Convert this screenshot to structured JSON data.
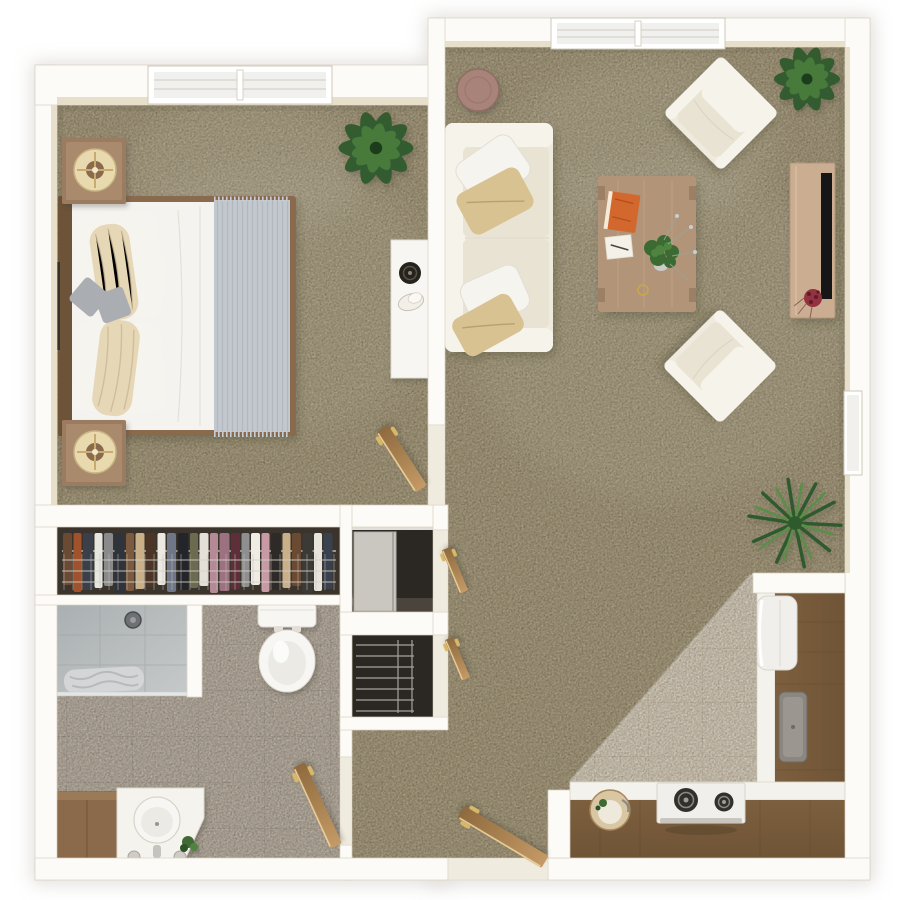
{
  "meta": {
    "title": "Top-down 3D floor plan render of a one-bedroom apartment",
    "style": "photoreal 3D dollhouse floorplan",
    "rooms_count": 6,
    "windows_count": 3,
    "doors_count": 5
  },
  "palette": {
    "page_bg": "#ffffff",
    "wall": "#fcfbf7",
    "wall_stroke": "#d9d2c2",
    "wall_inner": "#e8dfca",
    "threshold": "#f0ebdf",
    "halo": "#c9c5bd",
    "carpet": "#a09271",
    "tile_kitchen": "#d7cbb7",
    "tile_kitchen_line": "#c3b59f",
    "tile_bath": "#b6aa9b",
    "tile_bath_line": "#a2968a",
    "closet_dark": "#3a342c",
    "closet_dark2": "#2b2823",
    "wood_dark": "#6f5436",
    "wood_dark2": "#7c5f3e",
    "wood_mid": "#9b7c61",
    "wood_light": "#cbae91",
    "coffee_wood": "#b29478",
    "wood_door": "#c49a66",
    "wood_door_dk": "#8f6a3e",
    "door_highlight": "#ecd39f",
    "handle_gold": "#d8b768",
    "sofa_base": "#efeade",
    "sofa_light": "#f6f3ea",
    "cushion": "#e9e3d4",
    "seam": "#d5cebc",
    "pillow_white": "#f6f4ee",
    "pillow_tan": "#d9c291",
    "pillow_gray": "#aaaeb2",
    "bed_white": "#f5f3ef",
    "throw_gray": "#c3c8ce",
    "throw_ridge": "#b2b8c0",
    "counter_white": "#f4f2ed",
    "appliance_white": "#f1efeb",
    "burner_dark": "#32302c",
    "sink_gray": "#8b8680",
    "plant_dark": "#2f5a2e",
    "plant_mid": "#477a3a",
    "plant_light": "#5c8d48",
    "table_brown": "#a8837a",
    "book_orange": "#d2682e",
    "tv_black": "#191917",
    "flower_red": "#93333f",
    "shower_a": "#aab0b2",
    "shower_b": "#c6c9c9",
    "towel_gray": "#d3d5d6",
    "porcelain": "#f7f6f3",
    "tray_cream": "#e9d9ae",
    "frame_dark": "#35302a"
  },
  "closet": {
    "clothes": [
      {
        "c": "#6b4a33",
        "w": 9
      },
      {
        "c": "#a0522d",
        "w": 8
      },
      {
        "c": "#3a3f4a",
        "w": 10
      },
      {
        "c": "#e7e5e0",
        "w": 8
      },
      {
        "c": "#8a8a8c",
        "w": 9
      },
      {
        "c": "#2f333c",
        "w": 10
      },
      {
        "c": "#7b5a40",
        "w": 8
      },
      {
        "c": "#c9b089",
        "w": 9
      },
      {
        "c": "#4a3526",
        "w": 10
      },
      {
        "c": "#ece9e2",
        "w": 8
      },
      {
        "c": "#6e7687",
        "w": 9
      },
      {
        "c": "#23252b",
        "w": 11
      },
      {
        "c": "#6a6b4f",
        "w": 8
      },
      {
        "c": "#e3e0d8",
        "w": 9
      },
      {
        "c": "#b58a96",
        "w": 8
      },
      {
        "c": "#9c7180",
        "w": 10
      },
      {
        "c": "#5e2f38",
        "w": 9
      },
      {
        "c": "#8f8f91",
        "w": 8
      },
      {
        "c": "#efece5",
        "w": 9
      },
      {
        "c": "#c79aa6",
        "w": 8
      },
      {
        "c": "#2e2a28",
        "w": 10
      },
      {
        "c": "#c9b089",
        "w": 8
      },
      {
        "c": "#6b4a33",
        "w": 9
      },
      {
        "c": "#3c3a36",
        "w": 10
      },
      {
        "c": "#e7e4dd",
        "w": 8
      },
      {
        "c": "#39404e",
        "w": 9
      },
      {
        "c": "#7b5a40",
        "w": 9
      },
      {
        "c": "#2a2724",
        "w": 10
      }
    ]
  },
  "rooms": [
    {
      "id": "bedroom",
      "label": "Bedroom",
      "furniture": [
        "bed",
        "nightstand-top",
        "nightstand-bottom",
        "wall-art",
        "potted-plant",
        "white-desk",
        "speaker",
        "swing-door"
      ]
    },
    {
      "id": "living-room",
      "label": "Living Room",
      "furniture": [
        "sofa",
        "armchair-top",
        "armchair-bottom",
        "coffee-table",
        "round-side-table",
        "tv-console",
        "tv",
        "book",
        "notepad",
        "table-plant",
        "corner-plant",
        "window-plant"
      ]
    },
    {
      "id": "kitchen",
      "label": "Kitchen",
      "furniture": [
        "refrigerator",
        "right-counter",
        "inset-sink",
        "bottom-counter",
        "stove",
        "round-sink"
      ]
    },
    {
      "id": "bathroom",
      "label": "Bathroom",
      "furniture": [
        "shower",
        "towel",
        "toilet",
        "vanity-cabinet",
        "vanity-sink",
        "faucet-knobs",
        "small-plant",
        "swing-door"
      ]
    },
    {
      "id": "closet-hall",
      "label": "Closet Hall",
      "furniture": [
        "hanging-clothes",
        "wire-shelf",
        "sliding-closet",
        "linen-closet",
        "closet-door",
        "closet-door"
      ]
    },
    {
      "id": "entry",
      "label": "Entry",
      "furniture": [
        "entry-door"
      ]
    }
  ]
}
